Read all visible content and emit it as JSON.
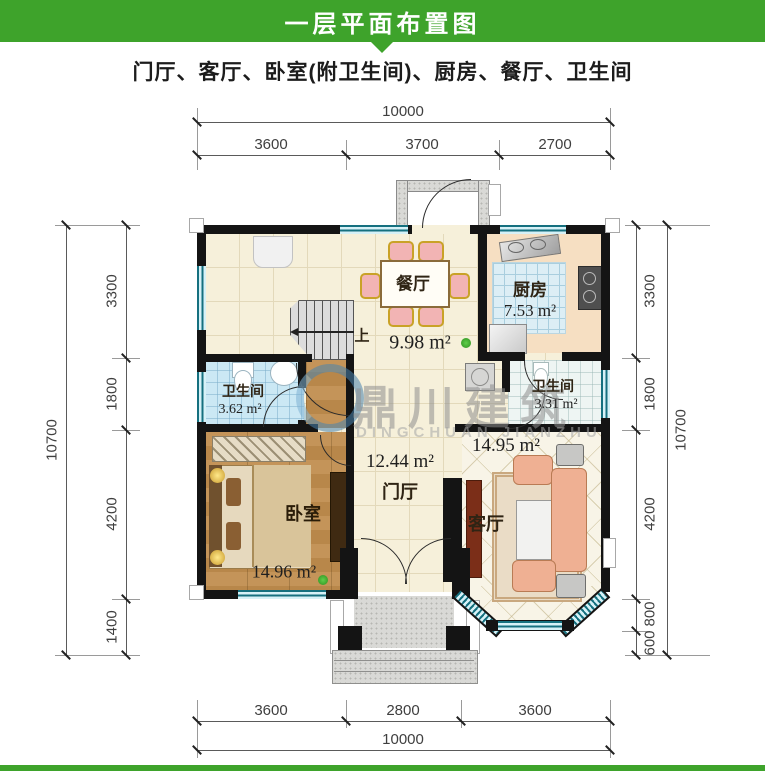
{
  "header": {
    "title": "一层平面布置图"
  },
  "subtitle": "门厅、客厅、卧室(附卫生间)、厨房、餐厅、卫生间",
  "dimensions": {
    "top": {
      "total": "10000",
      "segments": [
        "3600",
        "3700",
        "2700"
      ]
    },
    "bottom": {
      "total": "10000",
      "segments": [
        "3600",
        "2800",
        "3600"
      ]
    },
    "left": {
      "total": "10700",
      "segments": [
        "3300",
        "1800",
        "4200",
        "1400"
      ]
    },
    "right": {
      "total": "10700",
      "segments": [
        "3300",
        "1800",
        "4200",
        "800",
        "600"
      ]
    }
  },
  "rooms": {
    "dining": {
      "name": "餐厅",
      "area": "9.98 m²"
    },
    "kitchen": {
      "name": "厨房",
      "area": "7.53 m²"
    },
    "bath_left": {
      "name": "卫生间",
      "area": "3.62 m²"
    },
    "bath_right": {
      "name": "卫生间",
      "area": "3.31 m²"
    },
    "foyer": {
      "name": "门厅",
      "area": "12.44 m²"
    },
    "bedroom": {
      "name": "卧室",
      "area": "14.96 m²"
    },
    "living": {
      "name": "客厅",
      "area": "14.95 m²"
    }
  },
  "stairs": {
    "up_label": "上"
  },
  "watermark": {
    "cn": "鼎川建筑",
    "en": "DINGCHUAN JIANZHU"
  },
  "colors": {
    "header_green": "#3EA32B",
    "wall": "#141414",
    "window_teal": "#15707F",
    "floor_cream": "#F6F0DA",
    "kitchen_peach": "#F6DFC2",
    "bath_blue": "#CBE8F4",
    "bedroom_wood": "#C09055"
  }
}
